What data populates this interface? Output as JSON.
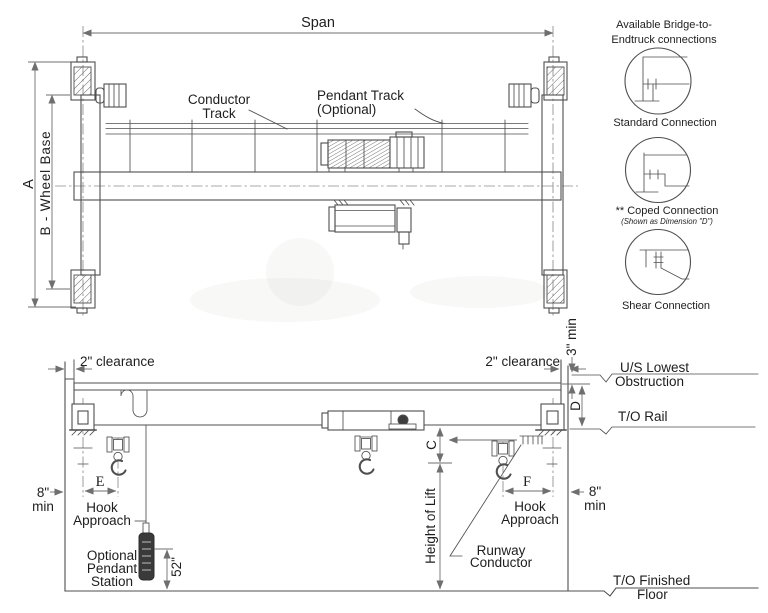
{
  "plan_view": {
    "span": "Span",
    "dim_a": "A",
    "dim_b": "B - Wheel Base",
    "conductor_track": [
      "Conductor",
      "Track"
    ],
    "pendant_track": [
      "Pendant Track",
      "(Optional)"
    ]
  },
  "connections": {
    "heading": [
      "Available Bridge-to-",
      "Endtruck connections"
    ],
    "items": [
      {
        "label": "Standard Connection"
      },
      {
        "label": "** Coped Connection",
        "note": "(Shown as Dimension \"D\")"
      },
      {
        "label": "Shear Connection"
      }
    ]
  },
  "elevation": {
    "clearance": "2\" clearance",
    "min_top": "3\" min",
    "us_lowest": [
      "U/S Lowest",
      "Obstruction"
    ],
    "to_rail": "T/O Rail",
    "dim_d": "D",
    "dim_c": "C",
    "dim_e": "E",
    "dim_f": "F",
    "hook_approach": [
      "Hook",
      "Approach"
    ],
    "min_side": [
      "8\"",
      "min"
    ],
    "height_of_lift": "Height of Lift",
    "pendant_station": [
      "Optional",
      "Pendant",
      "Station"
    ],
    "pendant_height": "52\"",
    "runway_conductor": [
      "Runway",
      "Conductor"
    ],
    "finished_floor": [
      "T/O Finished",
      "Floor"
    ]
  },
  "colors": {
    "line": "#4f4f4f",
    "dimension": "#6f6f6f",
    "text": "#1e1e1e",
    "background": "#ffffff"
  }
}
